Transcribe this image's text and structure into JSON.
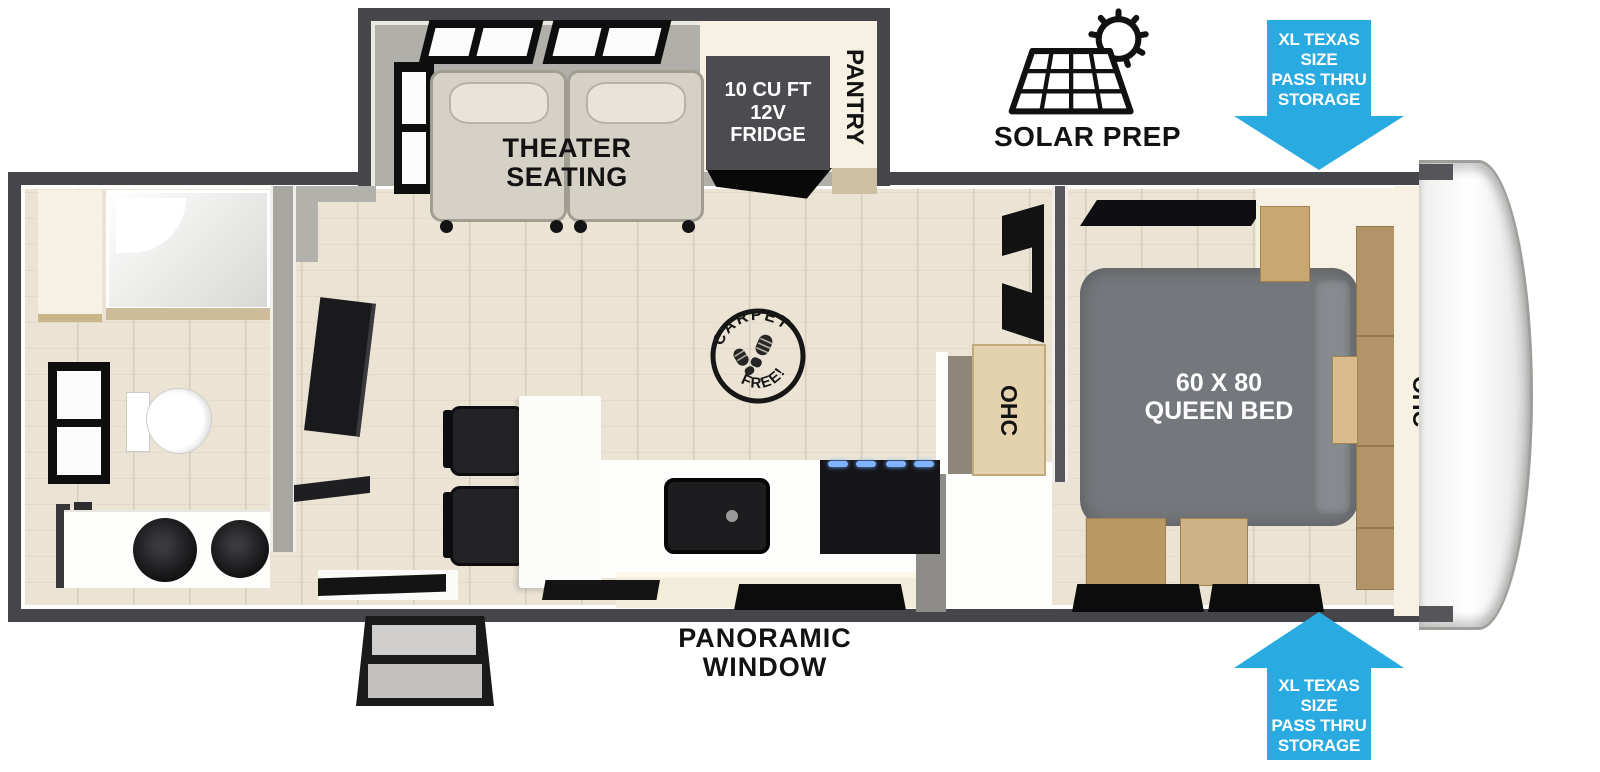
{
  "floorplan": {
    "slide": {
      "theater_line1": "THEATER",
      "theater_line2": "SEATING"
    },
    "kitchen": {
      "fridge_line1": "10 CU FT",
      "fridge_line2": "12V",
      "fridge_line3": "FRIDGE",
      "pantry": "PANTRY"
    },
    "hall": {
      "ohc": "OHC"
    },
    "bedroom": {
      "bed_line1": "60 X 80",
      "bed_line2": "QUEEN BED",
      "ohc_front": "OHC"
    },
    "badges": {
      "solar_prep": "SOLAR PREP",
      "carpet_free_top": "CARPET",
      "carpet_free_bottom": "FREE!",
      "pass_thru_top": {
        "line1": "XL TEXAS SIZE",
        "line2": "PASS THRU",
        "line3": "STORAGE"
      },
      "pass_thru_bottom": {
        "line1": "XL TEXAS SIZE",
        "line2": "PASS THRU",
        "line3": "STORAGE"
      },
      "panoramic_line1": "PANORAMIC",
      "panoramic_line2": "WINDOW"
    },
    "colors": {
      "arrow_blue": "#29abe2",
      "wall_dark": "#46464a",
      "bed_gray": "#74777b",
      "floor_wood": "#ebe4d5",
      "cabinet_cream": "#f6f1e2",
      "cabinet_wood": "#c8a872",
      "seat_beige": "#d5d1c6"
    }
  }
}
